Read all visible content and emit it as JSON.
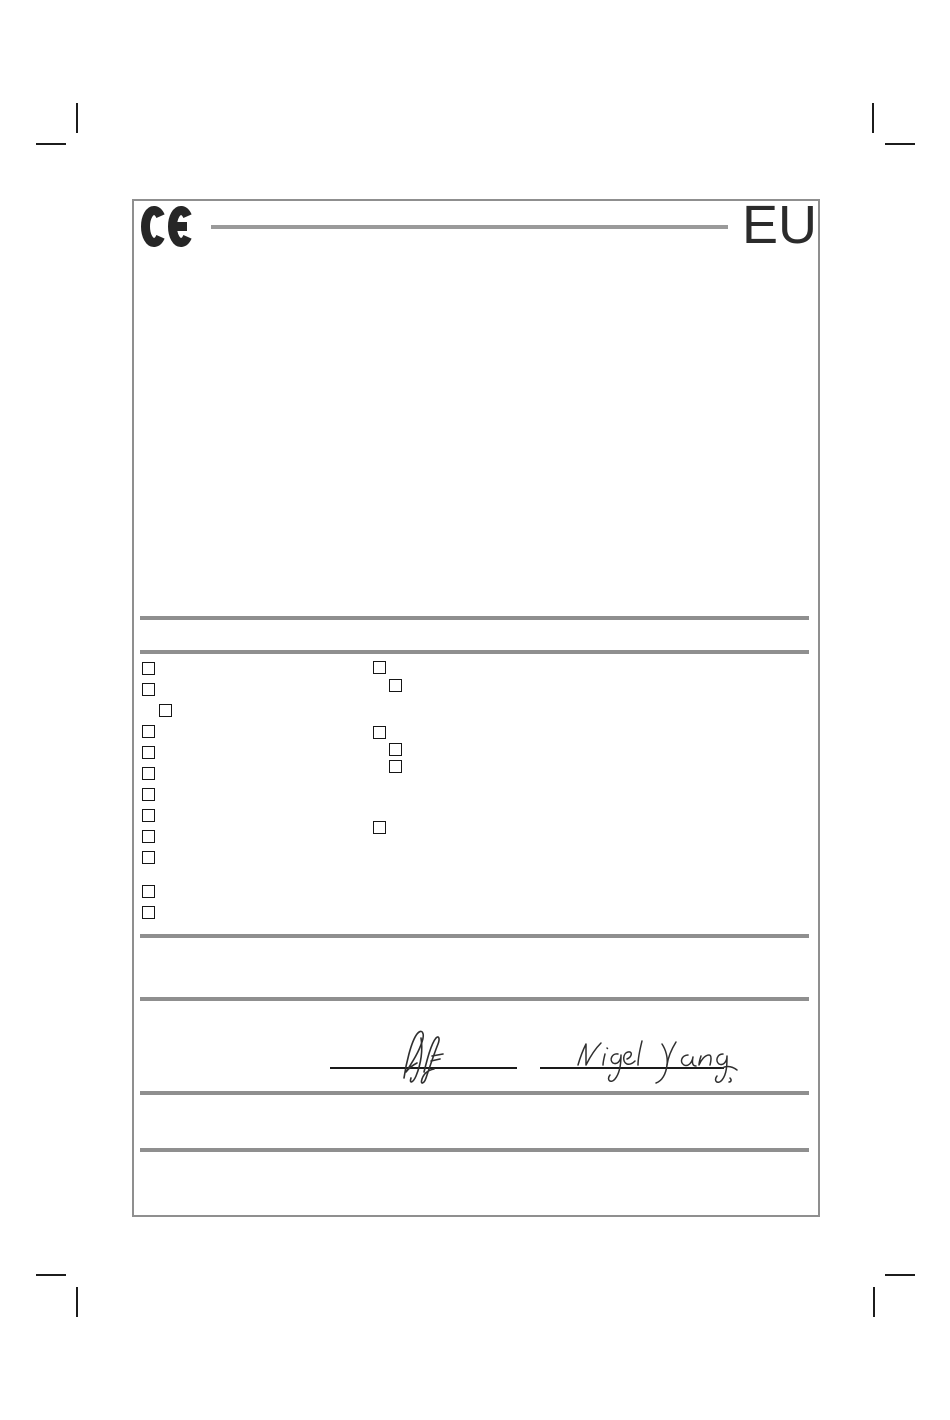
{
  "header": {
    "ce_logo": "CE",
    "region_label": "EU"
  },
  "colors": {
    "frame_gray": "#8f8f8f",
    "rule_gray": "#8f8f8f",
    "ink_black": "#262626"
  },
  "checkbox_groups": [
    {
      "name": "left-column",
      "origin": {
        "x": 142,
        "y": 662
      },
      "size": 13,
      "items": [
        {
          "dx": 0,
          "dy": 0,
          "checked": false
        },
        {
          "dx": 0,
          "dy": 21,
          "checked": false
        },
        {
          "dx": 17,
          "dy": 42,
          "checked": false
        },
        {
          "dx": 0,
          "dy": 63,
          "checked": false
        },
        {
          "dx": 0,
          "dy": 84,
          "checked": false
        },
        {
          "dx": 0,
          "dy": 105,
          "checked": false
        },
        {
          "dx": 0,
          "dy": 126,
          "checked": false
        },
        {
          "dx": 0,
          "dy": 147,
          "checked": false
        },
        {
          "dx": 0,
          "dy": 168,
          "checked": false
        },
        {
          "dx": 0,
          "dy": 189,
          "checked": false
        },
        {
          "dx": 0,
          "dy": 223,
          "checked": false
        },
        {
          "dx": 0,
          "dy": 244,
          "checked": false
        }
      ]
    },
    {
      "name": "middle-column",
      "origin": {
        "x": 373,
        "y": 661
      },
      "size": 13,
      "items": [
        {
          "dx": 0,
          "dy": 0,
          "checked": false
        },
        {
          "dx": 16,
          "dy": 18,
          "checked": false
        },
        {
          "dx": 0,
          "dy": 65,
          "checked": false
        },
        {
          "dx": 16,
          "dy": 82,
          "checked": false
        },
        {
          "dx": 16,
          "dy": 99,
          "checked": false
        },
        {
          "dx": 0,
          "dy": 160,
          "checked": false
        }
      ]
    }
  ],
  "signatures": {
    "left": {
      "style": "handwritten",
      "reads": "(illegible initials)"
    },
    "right": {
      "style": "handwritten",
      "reads": "Nigel Yang"
    }
  }
}
